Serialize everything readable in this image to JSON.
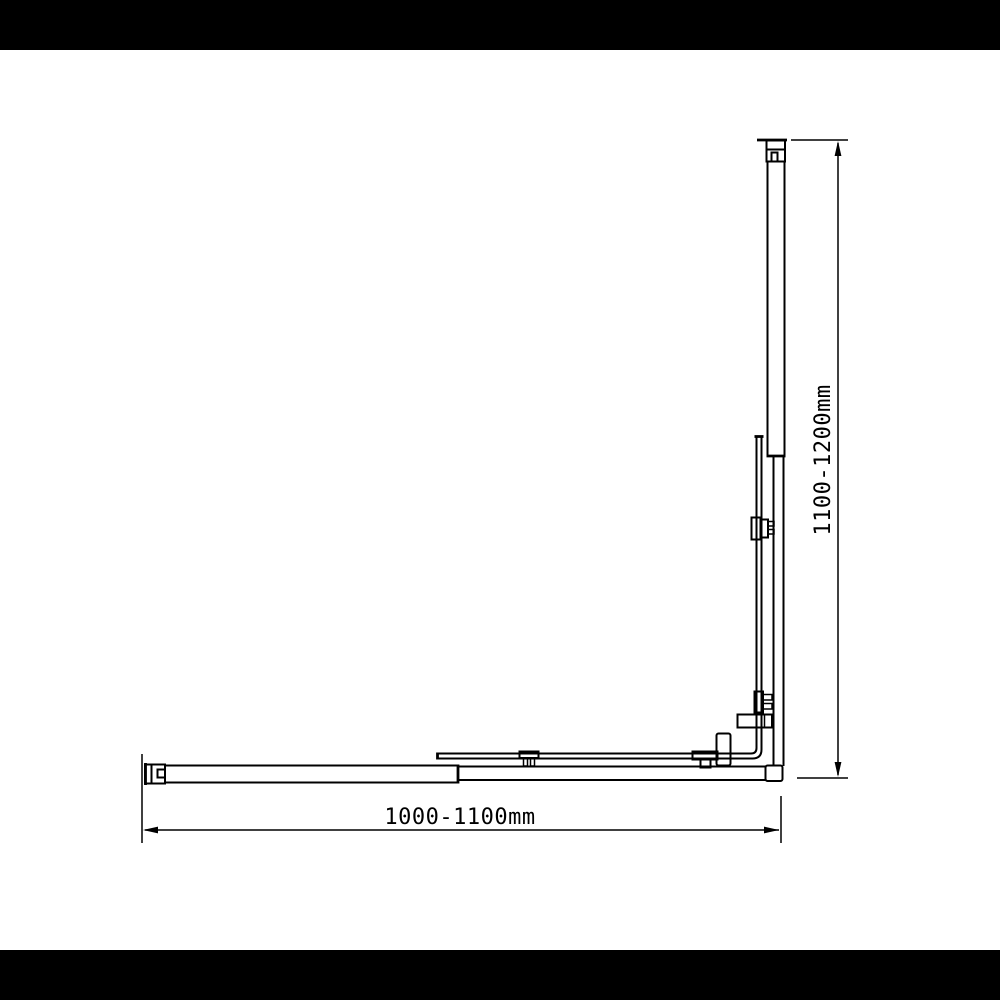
{
  "drawing": {
    "type": "technical-dimension-diagram",
    "subject": "corner shower screen plan view",
    "colors": {
      "line": "#000000",
      "background": "#ffffff",
      "letterbox": "#000000"
    },
    "dimensions": {
      "width": {
        "label": "1000-1100mm",
        "min_mm": 1000,
        "max_mm": 1100
      },
      "height": {
        "label": "1100-1200mm",
        "min_mm": 1100,
        "max_mm": 1200
      }
    }
  }
}
